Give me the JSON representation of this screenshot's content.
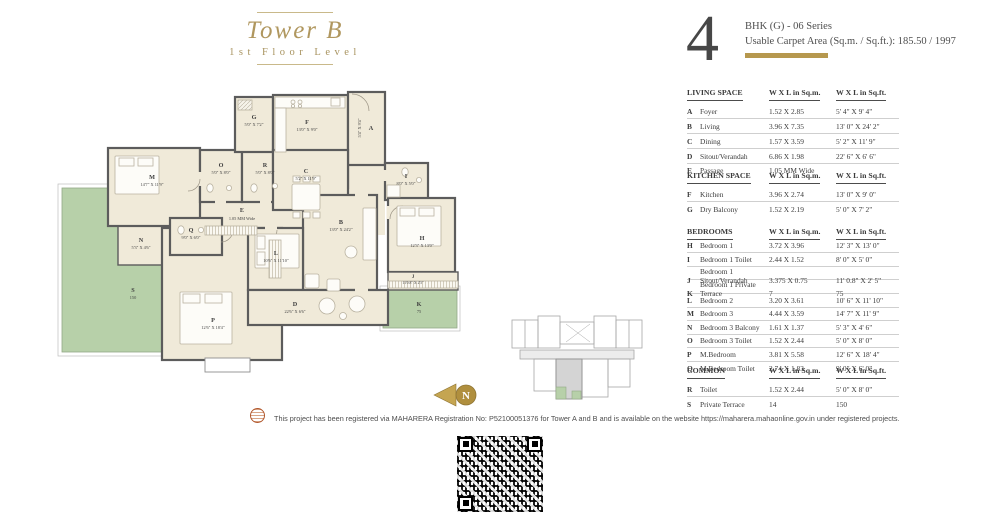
{
  "title": {
    "tower": "Tower B",
    "level": "1st Floor Level"
  },
  "unit": {
    "big_number": "4",
    "series": "BHK (G)  - 06 Series",
    "carpet_area": "Usable Carpet Area (Sq.m. / Sq.ft.): 185.50 / 1997"
  },
  "col_headers": {
    "sqm": "W X L in Sq.m.",
    "sqft": "W X L in Sq.ft."
  },
  "tables": {
    "living": {
      "header": "LIVING SPACE",
      "rows": [
        {
          "letter": "A",
          "label": "Foyer",
          "sqm": "1.52 X 2.85",
          "sqft": "5' 4\" X 9' 4\""
        },
        {
          "letter": "B",
          "label": "Living",
          "sqm": "3.96 X 7.35",
          "sqft": "13' 0\" X 24' 2\""
        },
        {
          "letter": "C",
          "label": "Dining",
          "sqm": "1.57 X 3.59",
          "sqft": "5' 2\" X 11' 9\""
        },
        {
          "letter": "D",
          "label": "Sitout/Verandah",
          "sqm": "6.86 X 1.98",
          "sqft": "22' 6\" X 6' 6\""
        },
        {
          "letter": "E",
          "label": "Passage",
          "sqm": "1.05 MM Wide",
          "sqft": ""
        }
      ]
    },
    "kitchen": {
      "header": "KITCHEN SPACE",
      "rows": [
        {
          "letter": "F",
          "label": "Kitchen",
          "sqm": "3.96 X 2.74",
          "sqft": "13' 0\" X 9' 0\""
        },
        {
          "letter": "G",
          "label": "Dry Balcony",
          "sqm": "1.52 X 2.19",
          "sqft": "5' 0\" X 7' 2\""
        }
      ]
    },
    "bedrooms": {
      "header": "BEDROOMS",
      "rows": [
        {
          "letter": "H",
          "label": "Bedroom 1",
          "sqm": "3.72 X 3.96",
          "sqft": "12' 3\" X 13' 0\""
        },
        {
          "letter": "I",
          "label": "Bedroom 1 Toilet",
          "sqm": "2.44 X 1.52",
          "sqft": "8' 0\" X 5' 0\""
        },
        {
          "letter": "J",
          "label": "Bedroom 1 Sitout/Verandah",
          "sqm": "3.375 X 0.75",
          "sqft": "11' 0.8\" X 2' 5\""
        },
        {
          "letter": "K",
          "label": "Bedroom 1 Private Terrace",
          "sqm": "7",
          "sqft": "75"
        },
        {
          "letter": "L",
          "label": "Bedroom 2",
          "sqm": "3.20 X 3.61",
          "sqft": "10' 6\" X 11' 10\""
        },
        {
          "letter": "M",
          "label": "Bedroom 3",
          "sqm": "4.44 X 3.59",
          "sqft": "14' 7\" X 11' 9\""
        },
        {
          "letter": "N",
          "label": "Bedroom 3 Balcony",
          "sqm": "1.61 X 1.37",
          "sqft": "5' 3\" X 4' 6\""
        },
        {
          "letter": "O",
          "label": "Bedroom 3 Toilet",
          "sqm": "1.52 X 2.44",
          "sqft": "5' 0\" X 8' 0\""
        },
        {
          "letter": "P",
          "label": "M.Bedroom",
          "sqm": "3.81 X 5.58",
          "sqft": "12' 6\" X 18' 4\""
        },
        {
          "letter": "Q",
          "label": "M.Bedroom Toilet",
          "sqm": "2.74 X 1.83",
          "sqft": "9' 0\" X 6' 0\""
        }
      ]
    },
    "common": {
      "header": "COMMON",
      "rows": [
        {
          "letter": "R",
          "label": "Toilet",
          "sqm": "1.52 X 2.44",
          "sqft": "5' 0\" X 8' 0\""
        },
        {
          "letter": "S",
          "label": "Private Terrace",
          "sqm": "14",
          "sqft": "150"
        }
      ]
    }
  },
  "plan": {
    "rooms": {
      "A": {
        "letter": "A",
        "dim": "5'4\" X 9'4\""
      },
      "B": {
        "letter": "B",
        "dim": "13'0\" X 24'2\""
      },
      "C": {
        "letter": "C",
        "dim": "5'2\" X 11'9\""
      },
      "D": {
        "letter": "D",
        "dim": "22'6\" X 6'6\""
      },
      "E": {
        "letter": "E",
        "dim": "1.05 MM Wide"
      },
      "F": {
        "letter": "F",
        "dim": "13'0\" X 9'0\""
      },
      "G": {
        "letter": "G",
        "dim": "5'0\" X 7'2\""
      },
      "H": {
        "letter": "H",
        "dim": "12'3\" X 13'0\""
      },
      "I": {
        "letter": "I",
        "dim": "8'0\" X 5'0\""
      },
      "J": {
        "letter": "J",
        "dim": "11'0.8\" X 2'5\""
      },
      "K": {
        "letter": "K",
        "dim": "75"
      },
      "L": {
        "letter": "L",
        "dim": "10'6\" X 11'10\""
      },
      "M": {
        "letter": "M",
        "dim": "14'7\" X 11'9\""
      },
      "N": {
        "letter": "N",
        "dim": "5'3\" X 4'6\""
      },
      "O": {
        "letter": "O",
        "dim": "5'0\" X 8'0\""
      },
      "P": {
        "letter": "P",
        "dim": "12'6\" X 18'4\""
      },
      "Q": {
        "letter": "Q",
        "dim": "9'0\" X 6'0\""
      },
      "R": {
        "letter": "R",
        "dim": "5'0\" X 8'0\""
      },
      "S": {
        "letter": "S",
        "dim": "150"
      }
    }
  },
  "compass": {
    "label": "N"
  },
  "disclaimer": "This project has been registered via MAHARERA Registration No: P52100051376 for Tower A and B and is available on the website https://maharera.mahaonline.gov.in under registered projects.",
  "colors": {
    "accent_gold": "#b6984e",
    "wall_gray": "#5c5c5c",
    "room_cream": "#f0ead9",
    "terrace_green": "#b7d0a9"
  }
}
